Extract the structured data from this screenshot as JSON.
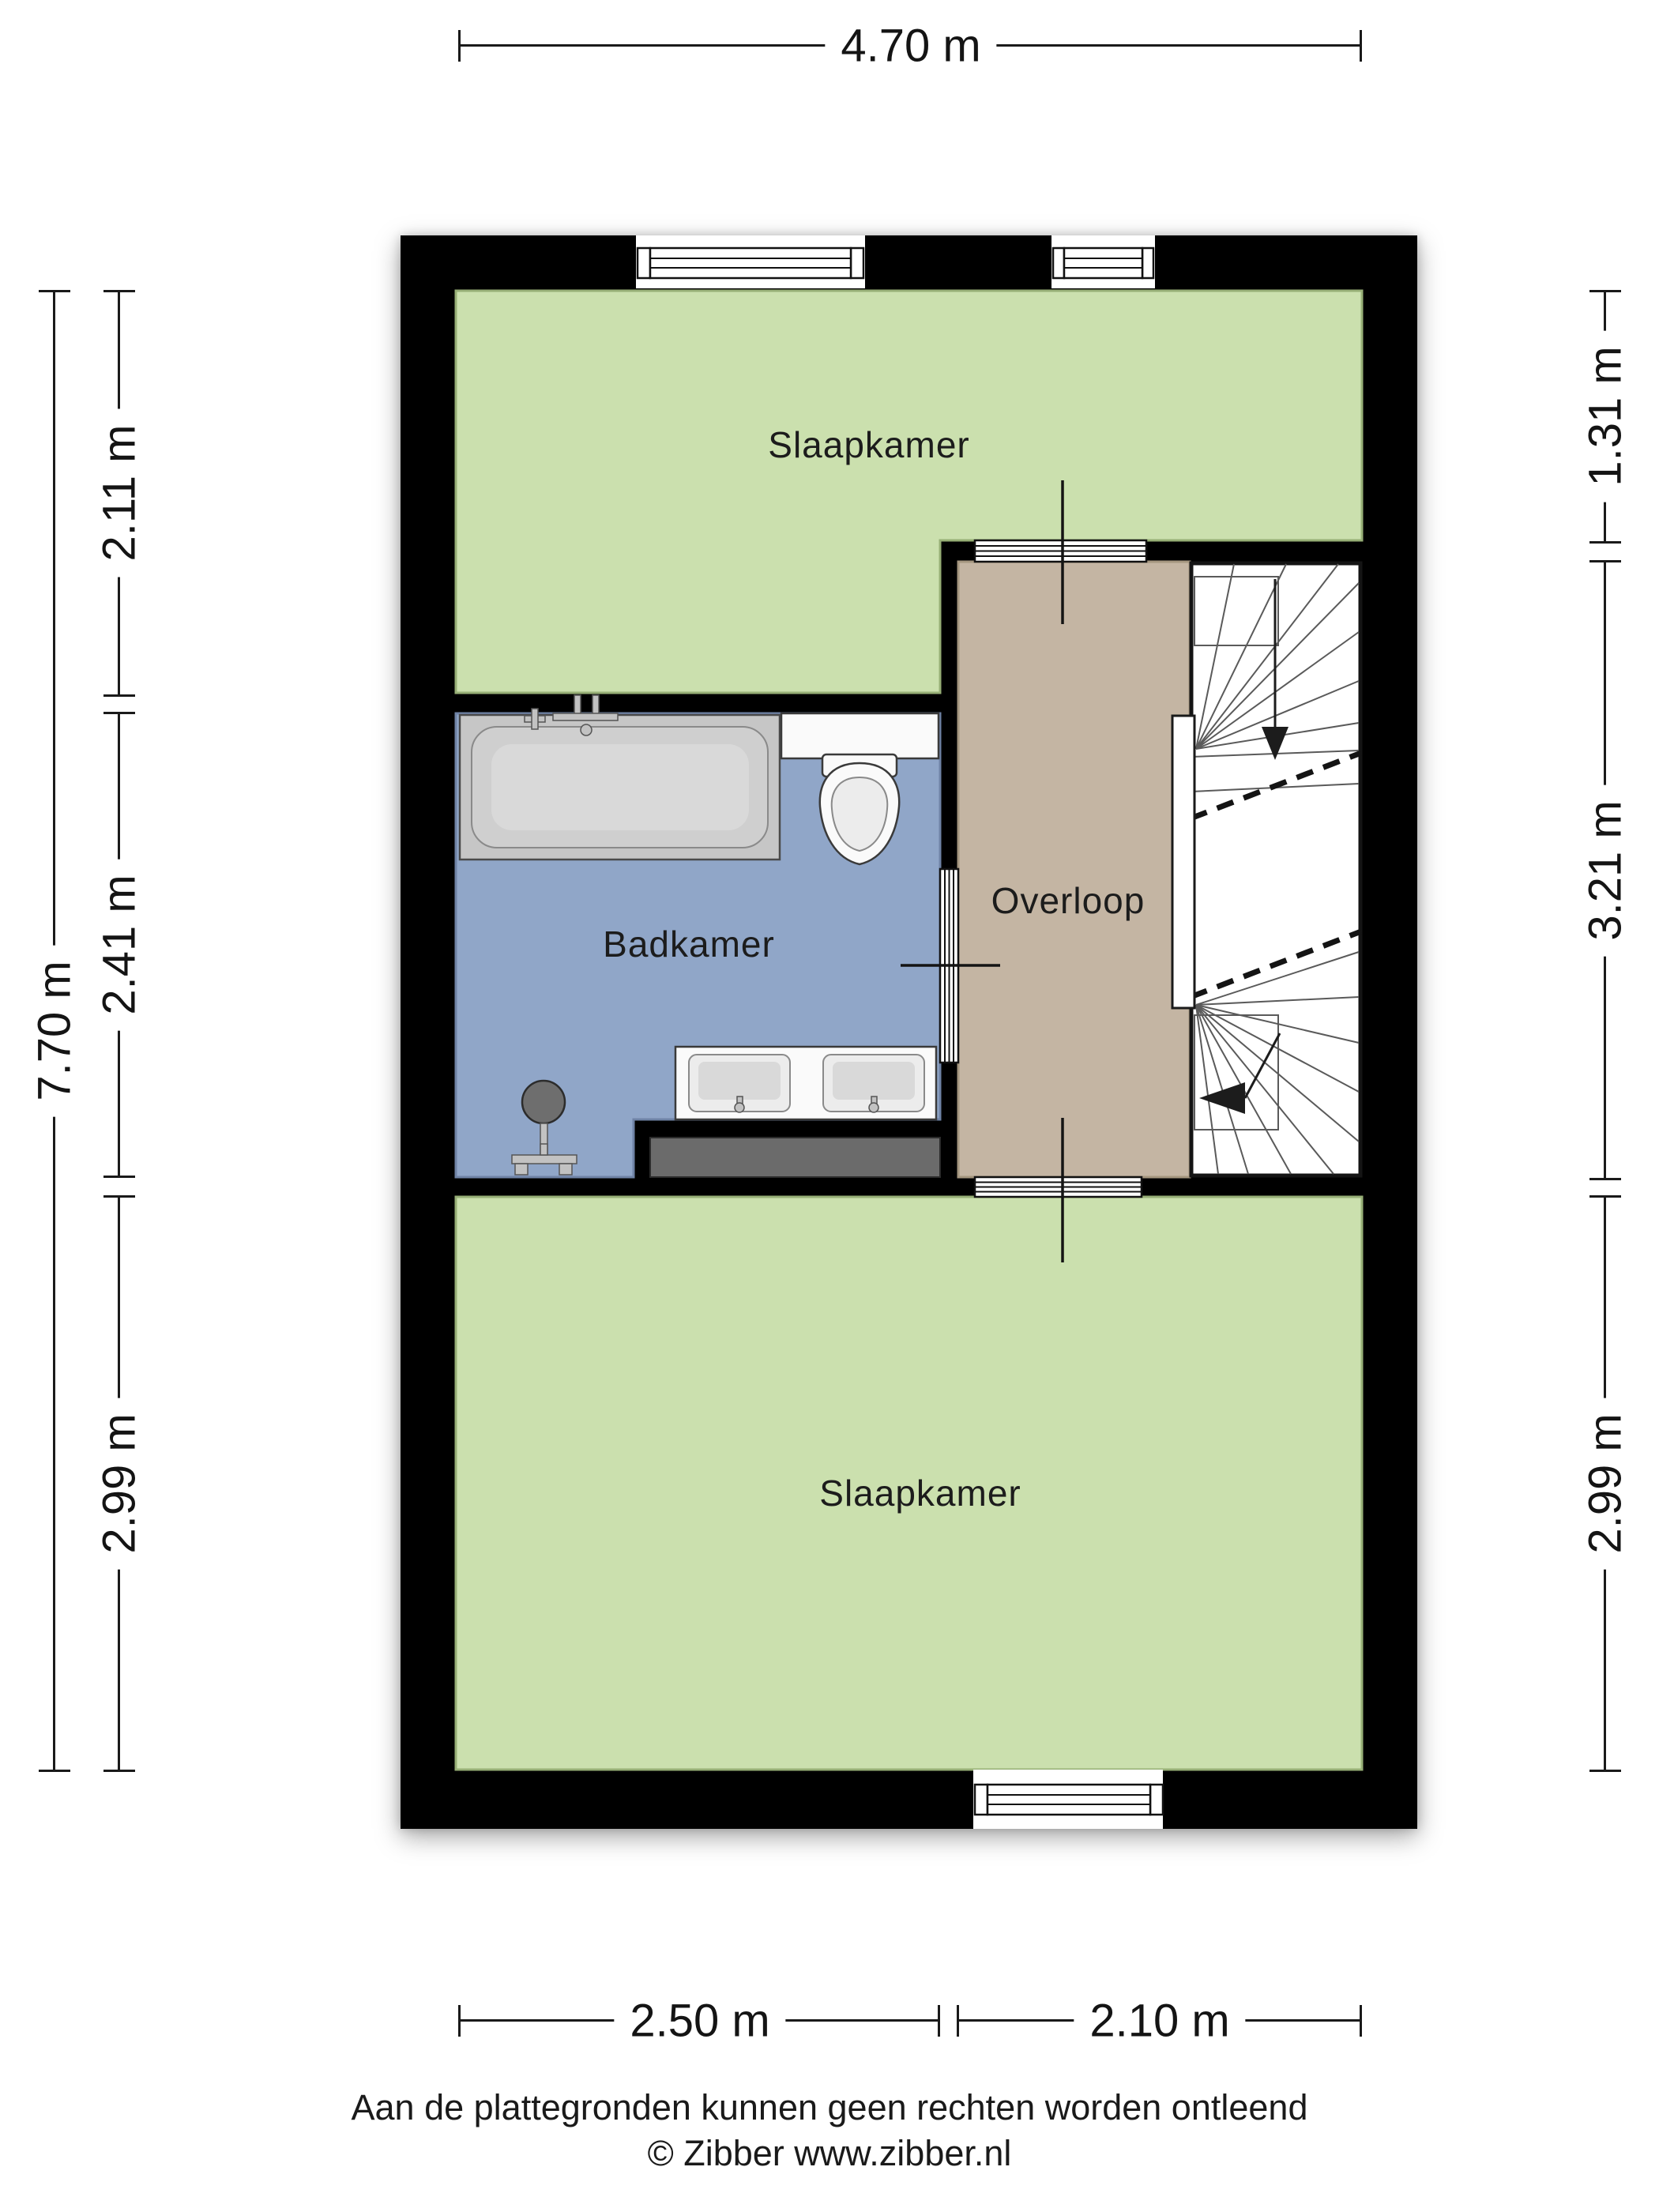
{
  "rooms": [
    {
      "id": "bedroom-top",
      "label": "Slaapkamer"
    },
    {
      "id": "bathroom",
      "label": "Badkamer"
    },
    {
      "id": "landing",
      "label": "Overloop"
    },
    {
      "id": "bedroom-bottom",
      "label": "Slaapkamer"
    }
  ],
  "dimensions": {
    "top_width": "4.70 m",
    "left_total": "7.70 m",
    "left_segments": [
      "2.11 m",
      "2.41 m",
      "2.99 m"
    ],
    "right_segments": [
      "1.31 m",
      "3.21 m",
      "2.99 m"
    ],
    "bottom_segments": [
      "2.50 m",
      "2.10 m"
    ]
  },
  "footer": {
    "disclaimer": "Aan de plattegronden kunnen geen rechten worden ontleend",
    "copyright": "© Zibber www.zibber.nl"
  },
  "colors": {
    "wall": "#000000",
    "bedroom-floor": "#CBE0AE",
    "bathroom-floor": "#90A6C8",
    "landing-floor": "#C4B5A3",
    "stairs": "#FFFFFF",
    "mat-gray": "#6B6B6B",
    "dimension-text": "#141414"
  }
}
